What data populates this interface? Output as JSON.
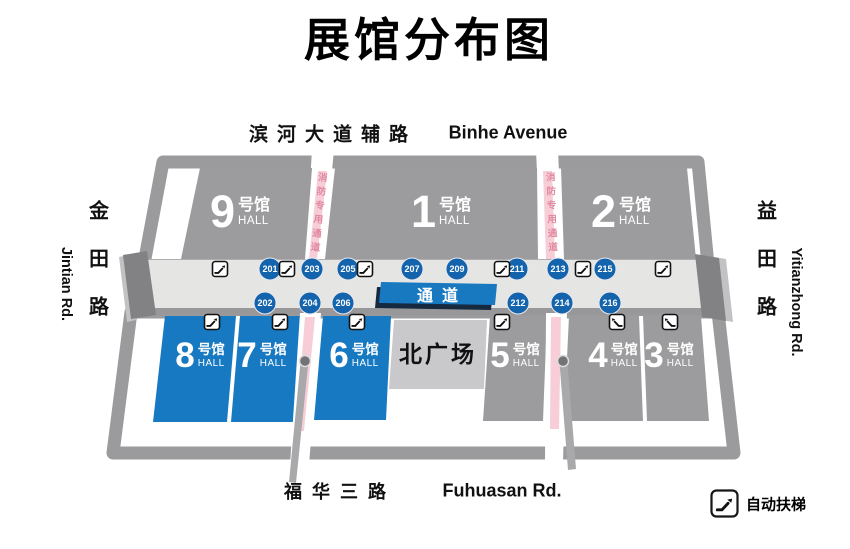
{
  "title": "展馆分布图",
  "roads": {
    "top_cn": "滨河大道辅路",
    "top_en": "Binhe Avenue",
    "bottom_cn": "福华三路",
    "bottom_en": "Fuhuasan Rd.",
    "left_cn": "金田路",
    "left_en": "Jintian Rd.",
    "right_cn": "益田路",
    "right_en": "Yitianzhong Rd."
  },
  "halls": {
    "h9": {
      "number": "9",
      "suffix": "号馆",
      "hall_word": "HALL"
    },
    "h1": {
      "number": "1",
      "suffix": "号馆",
      "hall_word": "HALL"
    },
    "h2": {
      "number": "2",
      "suffix": "号馆",
      "hall_word": "HALL"
    },
    "h8": {
      "number": "8",
      "suffix": "号馆",
      "hall_word": "HALL"
    },
    "h7": {
      "number": "7",
      "suffix": "号馆",
      "hall_word": "HALL"
    },
    "h6": {
      "number": "6",
      "suffix": "号馆",
      "hall_word": "HALL"
    },
    "h5": {
      "number": "5",
      "suffix": "号馆",
      "hall_word": "HALL"
    },
    "h4": {
      "number": "4",
      "suffix": "号馆",
      "hall_word": "HALL"
    },
    "h3": {
      "number": "3",
      "suffix": "号馆",
      "hall_word": "HALL"
    }
  },
  "plaza": {
    "label": "北广场"
  },
  "corridor": {
    "label": "通道",
    "gates_top": [
      "201",
      "203",
      "205",
      "207",
      "209",
      "211",
      "213",
      "215"
    ],
    "gates_bottom": [
      "202",
      "204",
      "206",
      "212",
      "214",
      "216"
    ]
  },
  "fire_lane": {
    "text": "消防专用通道"
  },
  "legend": {
    "escalator_label": "自动扶梯"
  },
  "colors": {
    "hall_gray": "#9c9c9e",
    "hall_blue": "#1779c1",
    "badge_blue": "#1464ad",
    "banner_blue": "#1879c0",
    "lane_pink": "#f7cdd8",
    "lane_text_pink": "#e08aa0",
    "plaza_gray": "#c9c9cb",
    "ring_gray": "#9b9b9d"
  }
}
